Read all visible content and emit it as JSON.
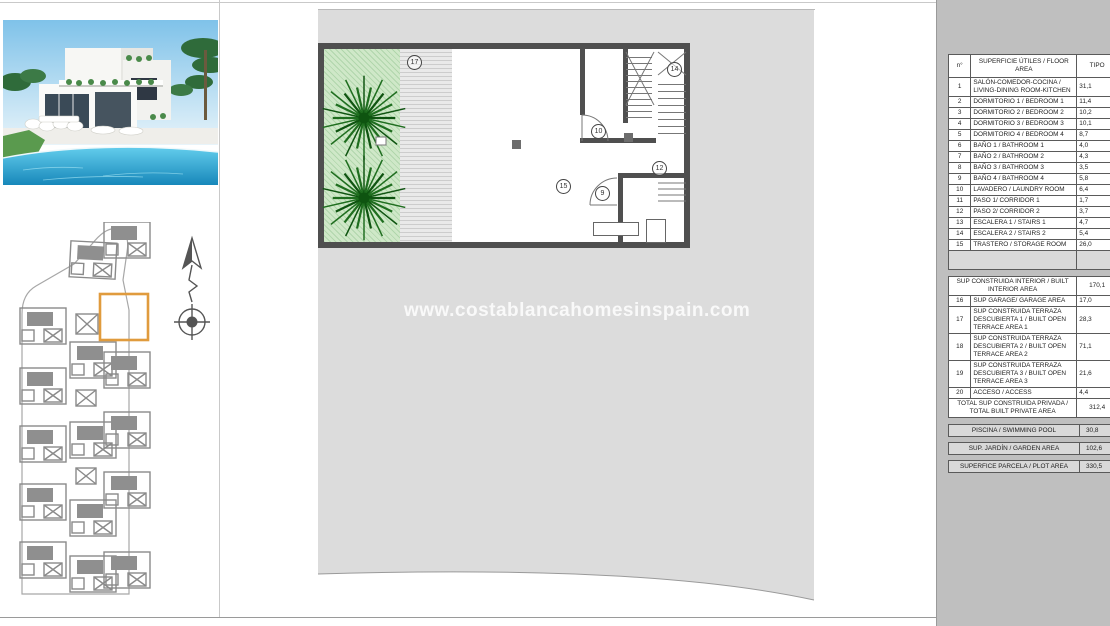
{
  "page": {
    "watermark": "www.costablancahomesinspain.com"
  },
  "colors": {
    "sheet_gray": "#dcdcdc",
    "panel_gray": "#bfbfbf",
    "wall_dark": "#4f4f4f",
    "garden_green": "#cfe8c8",
    "palm_green": "#1f6e1f",
    "highlight_orange": "#e09b3d",
    "pool_blue": "#2da3cd",
    "table_header_bg": "#d9d9d9"
  },
  "floor_plan": {
    "labels": {
      "terrace": "17",
      "stairs2": "14",
      "laundry": "10",
      "corridor2": "12",
      "storage": "15",
      "bath": "9"
    }
  },
  "area_table": {
    "header": {
      "num": "n°",
      "desc": "SUPERFICIE ÚTILES / FLOOR AREA",
      "tipo": "TIPO"
    },
    "rows": [
      {
        "n": "1",
        "label": "SALÓN-COMEDOR-COCINA / LIVING-DINING ROOM-KITCHEN",
        "value": "31,1"
      },
      {
        "n": "2",
        "label": "DORMITORIO 1 / BEDROOM 1",
        "value": "11,4"
      },
      {
        "n": "3",
        "label": "DORMITORIO 2 / BEDROOM 2",
        "value": "10,2"
      },
      {
        "n": "4",
        "label": "DORMITORIO 3 / BEDROOM 3",
        "value": "10,1"
      },
      {
        "n": "5",
        "label": "DORMITORIO 4 / BEDROOM 4",
        "value": "8,7"
      },
      {
        "n": "6",
        "label": "BAÑO 1 / BATHROOM 1",
        "value": "4,0"
      },
      {
        "n": "7",
        "label": "BAÑO 2 / BATHROOM 2",
        "value": "4,3"
      },
      {
        "n": "8",
        "label": "BAÑO 3 / BATHROOM 3",
        "value": "3,5"
      },
      {
        "n": "9",
        "label": "BAÑO 4 / BATHROOM 4",
        "value": "5,8"
      },
      {
        "n": "10",
        "label": "LAVADERO / LAUNDRY ROOM",
        "value": "6,4"
      },
      {
        "n": "11",
        "label": "PASO 1/ CORRIDOR 1",
        "value": "1,7"
      },
      {
        "n": "12",
        "label": "PASO 2/ CORRIDOR 2",
        "value": "3,7"
      },
      {
        "n": "13",
        "label": "ESCALERA 1 / STAIRS 1",
        "value": "4,7"
      },
      {
        "n": "14",
        "label": "ESCALERA 2 / STAIRS 2",
        "value": "5,4"
      },
      {
        "n": "15",
        "label": "TRASTERO / STORAGE ROOM",
        "value": "26,0"
      }
    ],
    "built_section": {
      "label": "SUP CONSTRUIDA INTERIOR / BUILT INTERIOR AREA",
      "value": "170,1"
    },
    "rows2": [
      {
        "n": "16",
        "label": "SUP GARAGE/ GARAGE AREA",
        "value": "17,0"
      },
      {
        "n": "17",
        "label": "SUP CONSTRUIDA TERRAZA DESCUBIERTA 1 / BUILT OPEN TERRACE AREA 1",
        "value": "28,3"
      },
      {
        "n": "18",
        "label": "SUP CONSTRUIDA TERRAZA DESCUBIERTA 2 / BUILT OPEN TERRACE AREA 2",
        "value": "71,1"
      },
      {
        "n": "19",
        "label": "SUP CONSTRUIDA TERRAZA DESCUBIERTA 3 / BUILT OPEN TERRACE AREA 3",
        "value": "21,6"
      },
      {
        "n": "20",
        "label": "ACCESO / ACCESS",
        "value": "4,4"
      }
    ],
    "total": {
      "label": "TOTAL SUP CONSTRUIDA PRIVADA / TOTAL BUILT PRIVATE AREA",
      "value": "312,4"
    },
    "footer_rows": [
      {
        "label": "PISCINA / SWIMMING POOL",
        "value": "30,8"
      },
      {
        "label": "SUP. JARDÍN / GARDEN AREA",
        "value": "102,6"
      },
      {
        "label": "SUPERFICE PARCELA / PLOT AREA",
        "value": "330,5"
      }
    ]
  }
}
